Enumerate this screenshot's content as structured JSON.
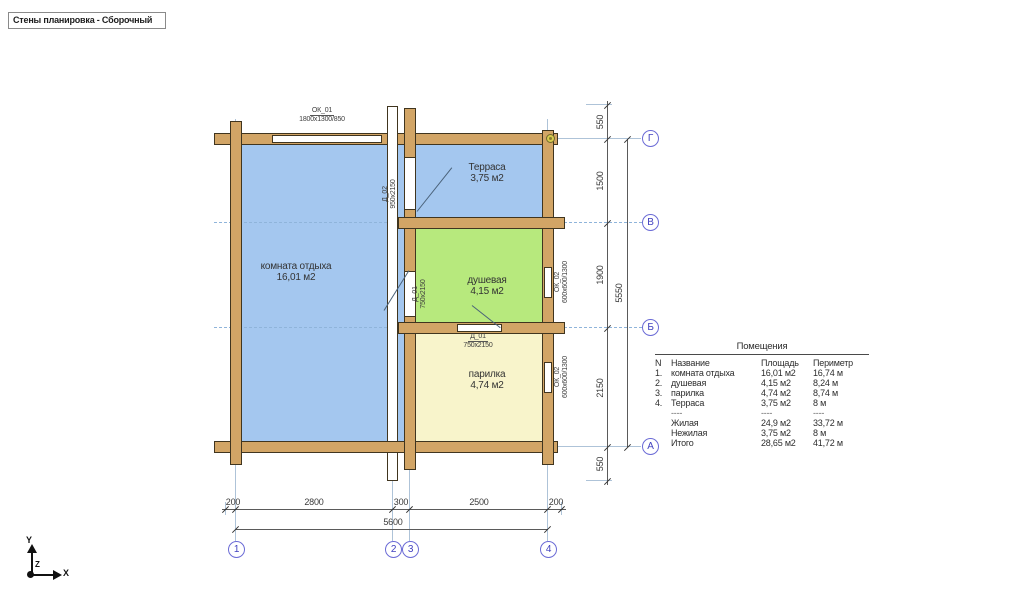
{
  "tab": {
    "title": "Стены планировка - Сборочный"
  },
  "plan": {
    "rooms": [
      {
        "name": "комната отдыха",
        "area": "16,01 м2",
        "color": "#a4c7ef"
      },
      {
        "name": "Терраса",
        "area": "3,75 м2",
        "color": "#a4c7ef"
      },
      {
        "name": "душевая",
        "area": "4,15 м2",
        "color": "#b7e97d"
      },
      {
        "name": "парилка",
        "area": "4,74 м2",
        "color": "#f8f4cb"
      }
    ],
    "openings": {
      "ok01": {
        "id": "ОК_01",
        "size": "1800х1300/850"
      },
      "d02": {
        "id": "Д_02",
        "size": "950х2150"
      },
      "d01_wall": {
        "id": "Д_01",
        "size": "750х2150"
      },
      "d01_part": {
        "id": "Д_01",
        "size": "750х2150"
      },
      "ok02_shower": {
        "id": "ОК_02",
        "size": "600х600/1300"
      },
      "ok02_sauna": {
        "id": "ОК_02",
        "size": "600х600/1300"
      }
    }
  },
  "dims": {
    "bottom": {
      "segs": [
        "200",
        "2800",
        "300",
        "2500",
        "200"
      ],
      "total": "5600"
    },
    "right": {
      "segs": [
        "550",
        "1500",
        "1900",
        "2150",
        "550"
      ],
      "total": "5550"
    }
  },
  "grid_axes": {
    "cols": [
      "1",
      "2",
      "3",
      "4"
    ],
    "rows": [
      "Г",
      "В",
      "Б",
      "А"
    ]
  },
  "table": {
    "title": "Помещения",
    "headers": [
      "N",
      "Название",
      "Площадь",
      "Периметр"
    ],
    "rows": [
      {
        "n": "1.",
        "name": "комната отдыха",
        "area": "16,01 м2",
        "perimeter": "16,74 м"
      },
      {
        "n": "2.",
        "name": "душевая",
        "area": "4,15 м2",
        "perimeter": "8,24 м"
      },
      {
        "n": "3.",
        "name": "парилка",
        "area": "4,74 м2",
        "perimeter": "8,74 м"
      },
      {
        "n": "4.",
        "name": "Терраса",
        "area": "3,75 м2",
        "perimeter": "8 м"
      },
      {
        "n": "",
        "name": "----",
        "area": "----",
        "perimeter": "----"
      },
      {
        "n": "",
        "name": "Жилая",
        "area": "24,9 м2",
        "perimeter": "33,72 м"
      },
      {
        "n": "",
        "name": "Нежилая",
        "area": "3,75 м2",
        "perimeter": "8 м"
      },
      {
        "n": "",
        "name": "Итого",
        "area": "28,65 м2",
        "perimeter": "41,72 м"
      }
    ]
  },
  "ucs": {
    "x": "X",
    "y": "Y",
    "z": "Z"
  }
}
